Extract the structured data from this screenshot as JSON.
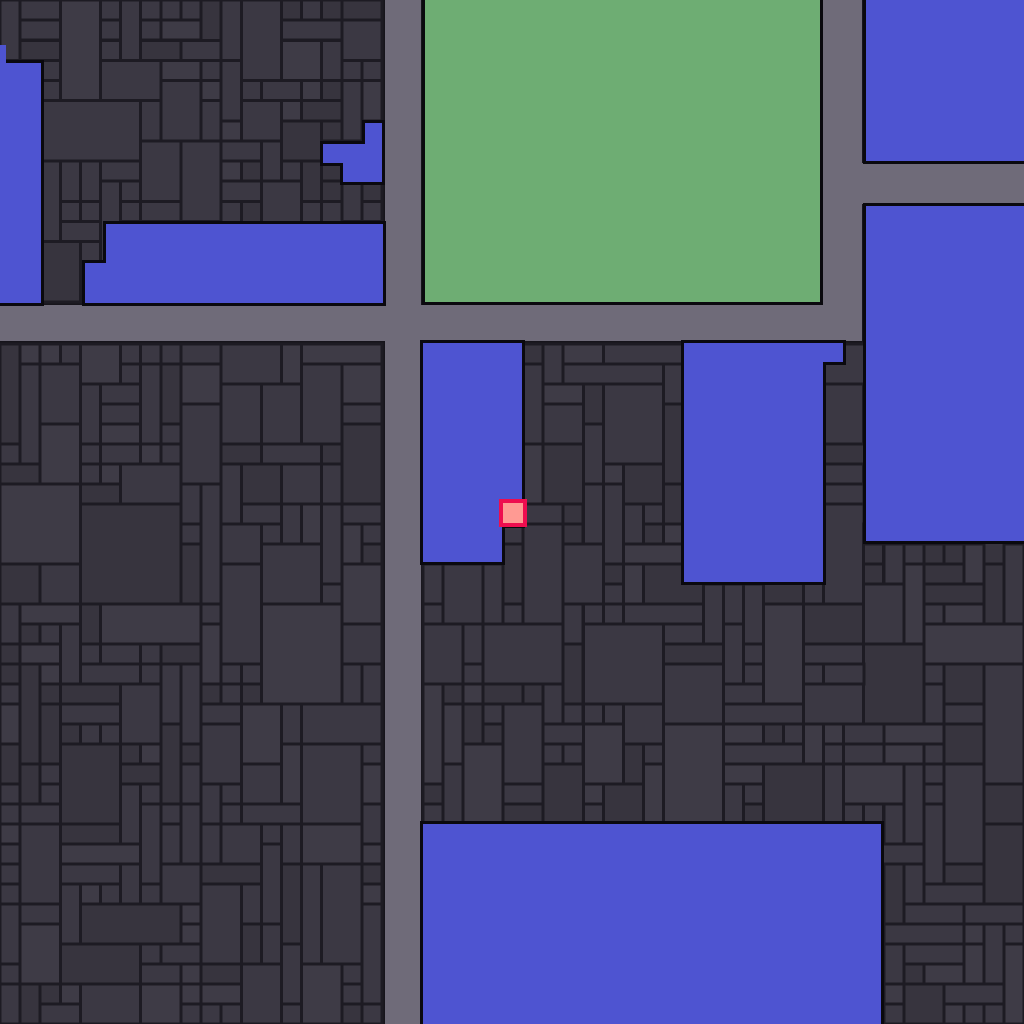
{
  "title": "tile-city-map",
  "map": {
    "width": 1024,
    "height": 1024,
    "lot_cell": 20,
    "colors": {
      "seam": "#16141b",
      "lot_fill": "#3b3843",
      "lot_fill_dark": "#37343e",
      "lot_fill_light": "#3e3b46",
      "lot_stroke": "#1d1b23",
      "road": "#6f6b79",
      "blue": "#4e54d1",
      "green": "#6ead73",
      "zone_outline": "#0a090e",
      "cursor_fill": "#ff9a93",
      "cursor_stroke": "#ee0d4f"
    },
    "roads": [
      {
        "id": "road-vertical-main",
        "x": 385,
        "y": 0,
        "w": 36,
        "h": 1024
      },
      {
        "id": "road-horizontal-main",
        "x": 0,
        "y": 305,
        "w": 862,
        "h": 36
      },
      {
        "id": "road-vertical-northeast",
        "x": 823,
        "y": 0,
        "w": 39,
        "h": 341
      },
      {
        "id": "road-horizontal-northeast",
        "x": 862,
        "y": 163,
        "w": 162,
        "h": 41
      }
    ],
    "blocks": [
      {
        "id": "block-northwest",
        "x": 0,
        "y": 0,
        "w": 382,
        "h": 302,
        "seed": 101
      },
      {
        "id": "block-southwest",
        "x": 0,
        "y": 344,
        "w": 382,
        "h": 680,
        "seed": 202
      },
      {
        "id": "block-east",
        "x": 423,
        "y": 344,
        "w": 601,
        "h": 680,
        "seed": 303
      }
    ],
    "zones": [
      {
        "id": "green-zone-park",
        "kind": "green",
        "rects": [
          [
            425,
            0,
            395,
            302
          ]
        ]
      },
      {
        "id": "blue-zone-west-strip",
        "kind": "blue",
        "rects": [
          [
            0,
            63,
            41,
            240
          ],
          [
            0,
            45,
            6,
            20
          ]
        ]
      },
      {
        "id": "blue-zone-northwest",
        "kind": "blue",
        "rects": [
          [
            106,
            224,
            277,
            79
          ],
          [
            85,
            263,
            21,
            40
          ]
        ]
      },
      {
        "id": "blue-zone-northwest-small",
        "kind": "blue",
        "rects": [
          [
            365,
            123,
            17,
            59
          ],
          [
            343,
            144,
            22,
            38
          ],
          [
            323,
            144,
            20,
            19
          ]
        ]
      },
      {
        "id": "blue-zone-northeast",
        "kind": "blue",
        "rects": [
          [
            866,
            0,
            158,
            161
          ]
        ]
      },
      {
        "id": "blue-zone-east-large",
        "kind": "blue",
        "rects": [
          [
            866,
            206,
            158,
            335
          ]
        ]
      },
      {
        "id": "blue-zone-center-west",
        "kind": "blue",
        "rects": [
          [
            423,
            343,
            99,
            182
          ],
          [
            423,
            525,
            79,
            37
          ]
        ]
      },
      {
        "id": "blue-zone-center",
        "kind": "blue",
        "rects": [
          [
            684,
            343,
            139,
            239
          ],
          [
            823,
            343,
            20,
            19
          ]
        ]
      },
      {
        "id": "blue-zone-south-large",
        "kind": "blue",
        "rects": [
          [
            423,
            824,
            458,
            200
          ]
        ]
      }
    ],
    "cursor": {
      "x": 501,
      "y": 501,
      "w": 24,
      "h": 24
    }
  }
}
